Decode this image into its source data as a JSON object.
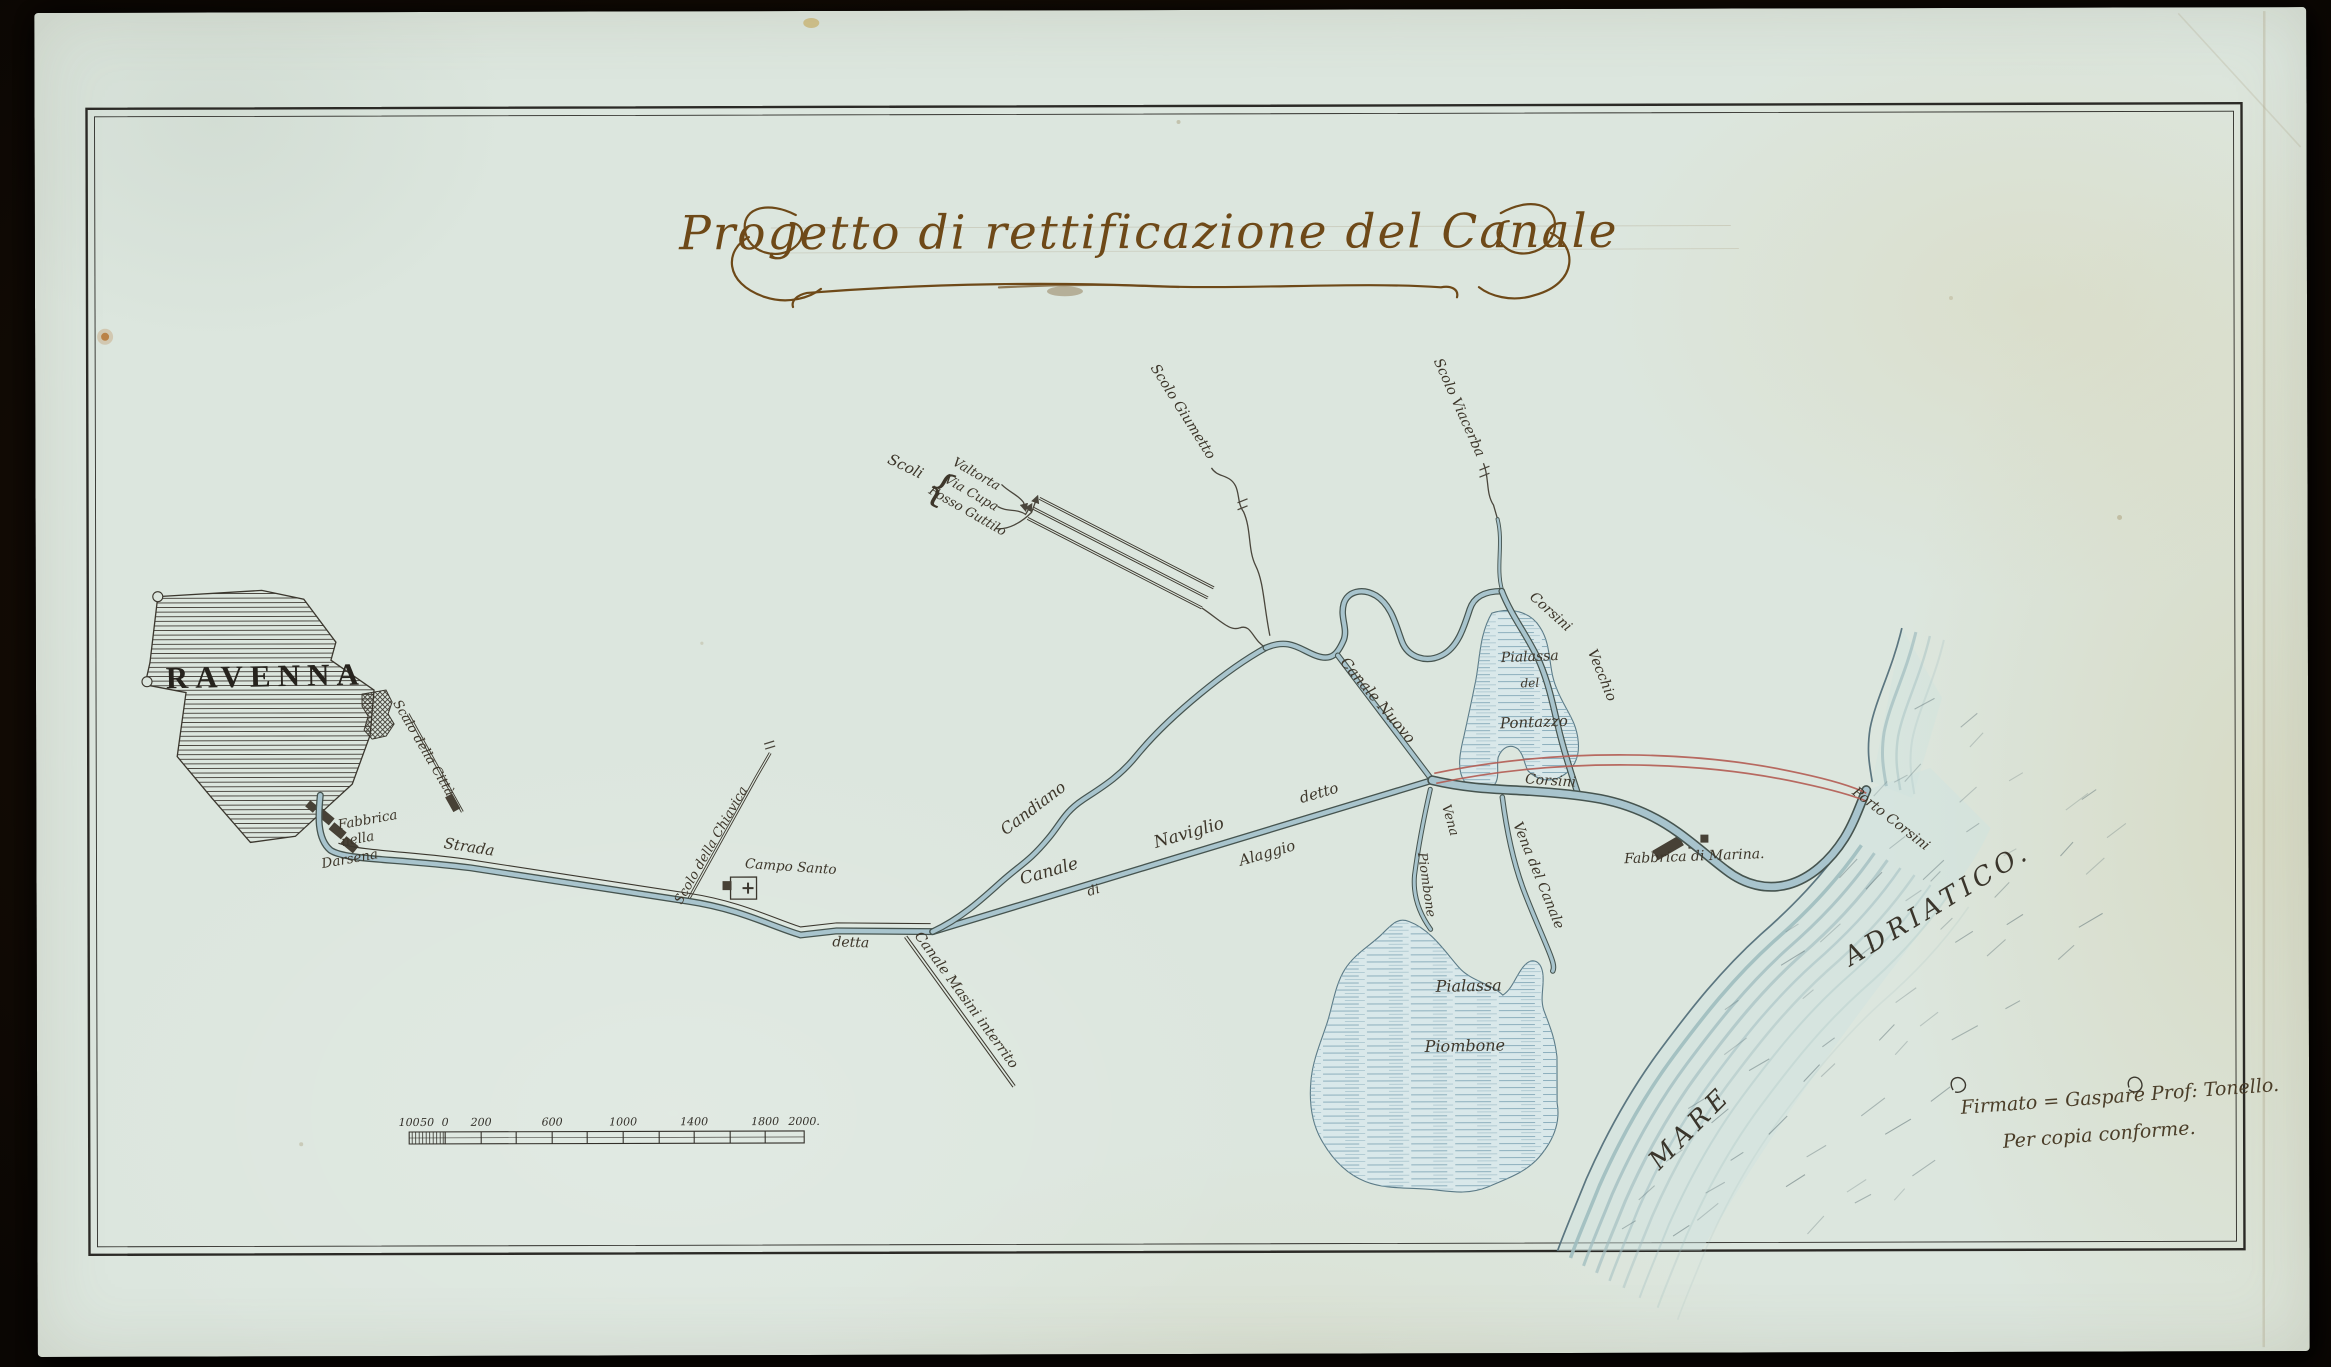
{
  "title": "Progetto di rettificazione del Canale",
  "city": "RAVENNA",
  "labels": {
    "scalo_citta": "Scalo della Città",
    "fabbrica_darsena": [
      "Fabbrica",
      "nella",
      "Darsena"
    ],
    "strada": "Strada",
    "scolo_chiavica": "Scolo della Chiavica",
    "campo_santo": "Campo Santo",
    "detta": "detta",
    "canale_masini": "Canale Masini interrito",
    "candiano": "Candiano",
    "canale_word": "Canale",
    "di_word": "di",
    "naviglio_word": "Naviglio",
    "alaggio_word": "Alaggio",
    "detto_word": "detto",
    "scoli_header": "Scoli",
    "scoli_brace": "{",
    "scoli_names": [
      "Valtorta",
      "Via Cupa",
      "Fosso Guttilo"
    ],
    "scolo_giumetto": "Scolo Giumetto",
    "scolo_viacerba": "Scolo Viacerba",
    "corsini_vecchio": [
      "Corsini",
      "Vecchio"
    ],
    "canale_nuovo": "Canale Nuovo",
    "corsini": "Corsini",
    "pialassa_pontazzo": [
      "Pialassa",
      "del",
      "Pontazzo"
    ],
    "vena_piombone": [
      "Vena",
      "Piombone"
    ],
    "vena_del_canale": "Vena del Canale",
    "pialassa_piombone": [
      "Pialassa",
      "Piombone"
    ],
    "fabbrica_marina": "Fabbrica di Marina.",
    "porto_corsini": "Porto Corsini",
    "mare": "MARE",
    "adriatico": "ADRIATICO."
  },
  "scale_bar": {
    "left_labels": [
      "100",
      "50",
      "0"
    ],
    "tick_labels": [
      "200",
      "600",
      "1000",
      "1400",
      "1800"
    ],
    "end_label": "2000."
  },
  "signature": [
    "Firmato = Gaspare Prof: Tonello.",
    "Per copia conforme."
  ],
  "colors": {
    "paper": "#dce6de",
    "ink": "#3b372e",
    "title_ink": "#6e4918",
    "water_line": "#46544f",
    "water_fill": "#a8c4cd",
    "lagoon_fill": "#d9e8ea",
    "sea_wash": "#9fbcbf",
    "project_red": "#b25b52"
  }
}
